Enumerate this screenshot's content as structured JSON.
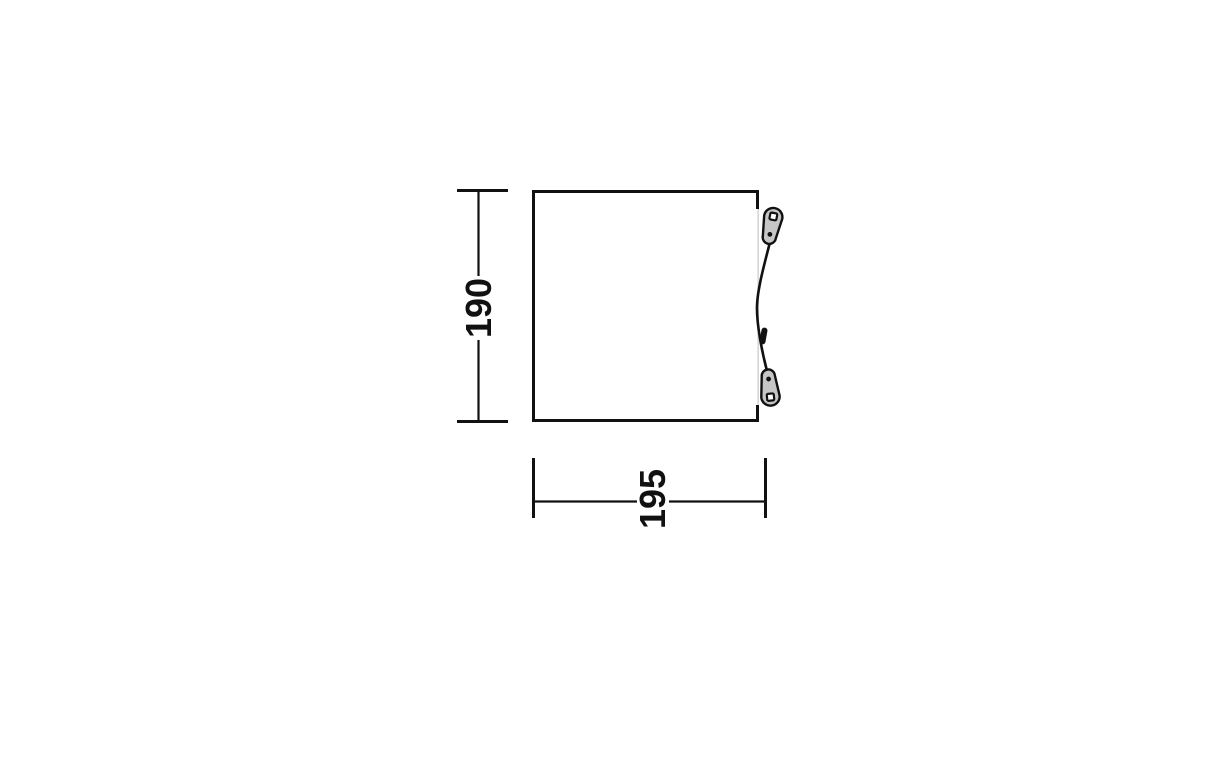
{
  "diagram": {
    "kind": "product-dimension-floorplan",
    "height_label": "190",
    "width_label": "195"
  },
  "colors": {
    "line": "#111111",
    "clip_fill": "#c6c6c6",
    "door_edge": "#d6d6d6",
    "text": "#111111",
    "background": "#ffffff"
  },
  "icons": {
    "top_clip": "guyline-peg-clip",
    "bottom_clip": "guyline-peg-clip",
    "adjuster": "guyline-adjuster"
  }
}
